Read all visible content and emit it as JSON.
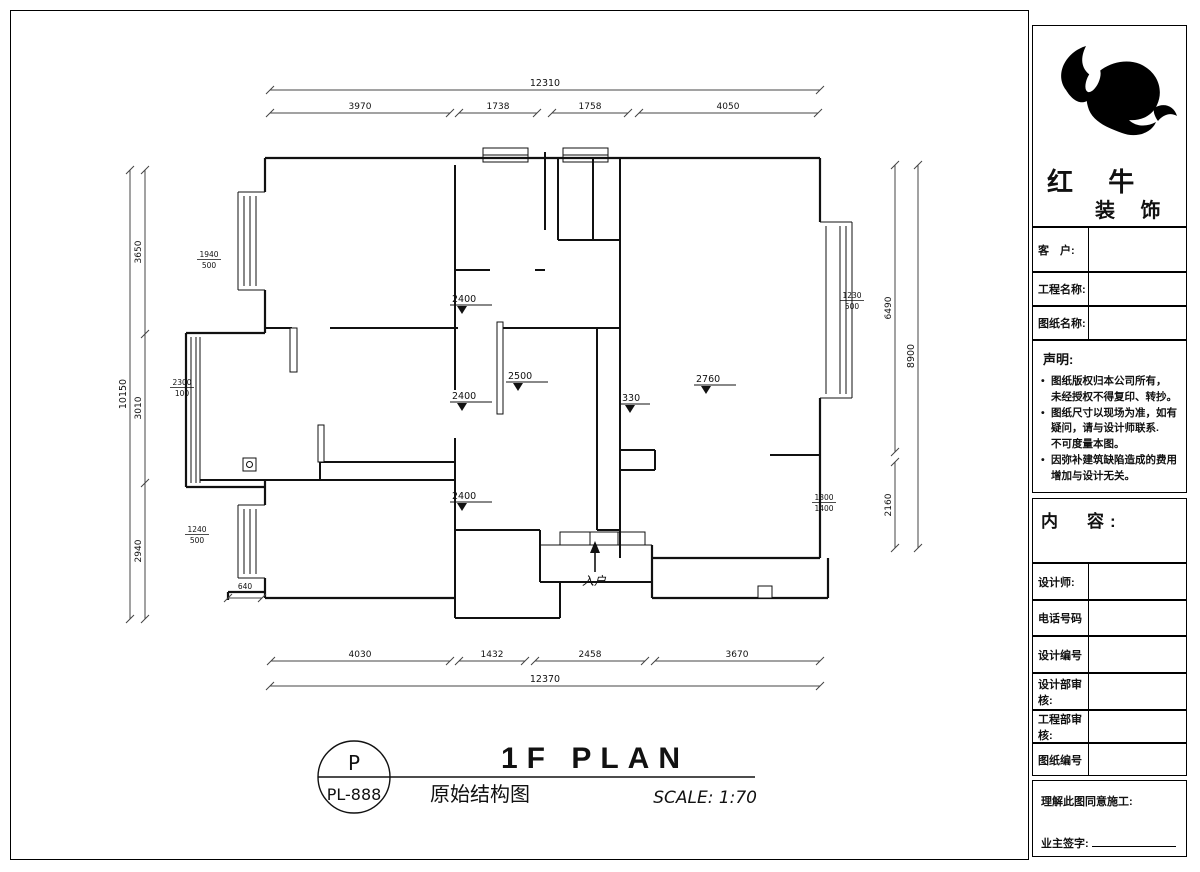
{
  "titleblock": {
    "big": "1F PLAN",
    "cn": "原始结构图",
    "scale": "SCALE: 1:70",
    "circle_top": "P",
    "circle_bottom": "PL-888"
  },
  "dims": {
    "top": {
      "overall": "12310",
      "seg1": "3970",
      "seg2": "1738",
      "seg3": "1758",
      "seg4": "4050"
    },
    "bottom": {
      "overall": "12370",
      "seg1": "4030",
      "seg2": "1432",
      "seg3": "2458",
      "seg4": "3670"
    },
    "left": {
      "overall": "10150",
      "seg1": "3650",
      "seg2": "3010",
      "seg3": "2940"
    },
    "right": {
      "overall": "8900",
      "seg1": "6490",
      "seg2": "2160"
    },
    "step": "640"
  },
  "markers": {
    "m1": "2400",
    "m2": "2500",
    "m3": "2400",
    "m4": "330",
    "m5": "2760",
    "m6": "2400"
  },
  "windows": {
    "w1t": "1940",
    "w1b": "500",
    "w2t": "2300",
    "w2b": "100",
    "w3t": "1240",
    "w3b": "500",
    "w4t": "1230",
    "w4b": "500",
    "w5t": "1300",
    "w5b": "1400"
  },
  "entrance_label": "入户",
  "company": {
    "name1": "红 牛",
    "name2": "装 饰"
  },
  "panel": {
    "customer": "客　户:",
    "project": "工程名称:",
    "drawing": "图纸名称:",
    "statement_title": "声明:",
    "b1l1": "图纸版权归本公司所有，",
    "b1l2": "未经授权不得复印、转抄。",
    "b2l1": "图纸尺寸以现场为准，如有",
    "b2l2": "疑问，请与设计师联系.",
    "b2l3": "不可度量本图。",
    "b3l1": "因弥补建筑缺陷造成的费用",
    "b3l2": "增加与设计无关。",
    "content_title": "内　容:",
    "designer": "设计师:",
    "phone": "电话号码",
    "design_no": "设计编号",
    "design_review": "设计部审核:",
    "eng_review": "工程部审核:",
    "sheet_no": "图纸编号",
    "sign1": "理解此图同意施工:",
    "sign2": "业主签字:"
  }
}
